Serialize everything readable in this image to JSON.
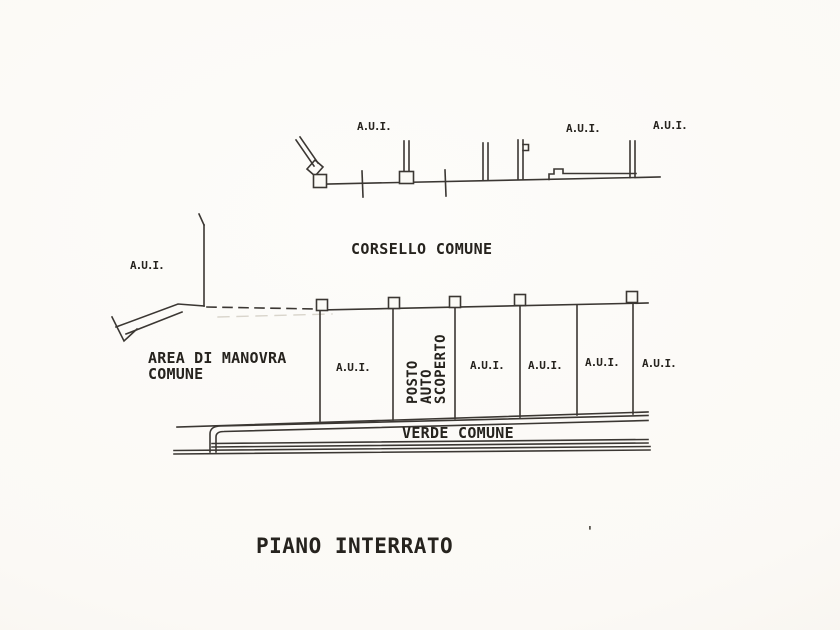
{
  "plan": {
    "title": "PIANO INTERRATO",
    "upper_units": [
      "A.U.I.",
      "A.U.I.",
      "A.U.I."
    ],
    "corridor_label": "CORSELLO COMUNE",
    "left_unit_label": "A.U.I.",
    "maneuver_area": {
      "line1": "AREA DI MANOVRA",
      "line2": "COMUNE"
    },
    "stall_units": [
      "A.U.I.",
      "A.U.I.",
      "A.U.I.",
      "A.U.I.",
      "A.U.I."
    ],
    "parking_stall": {
      "line1": "POSTO",
      "line2": "AUTO",
      "line3": "SCOPERTO"
    },
    "green_area_label": "VERDE COMUNE",
    "stray_mark": "'",
    "colors": {
      "ink": "#3b3733",
      "text": "#26231e",
      "paper": "#fbfaf6"
    }
  }
}
